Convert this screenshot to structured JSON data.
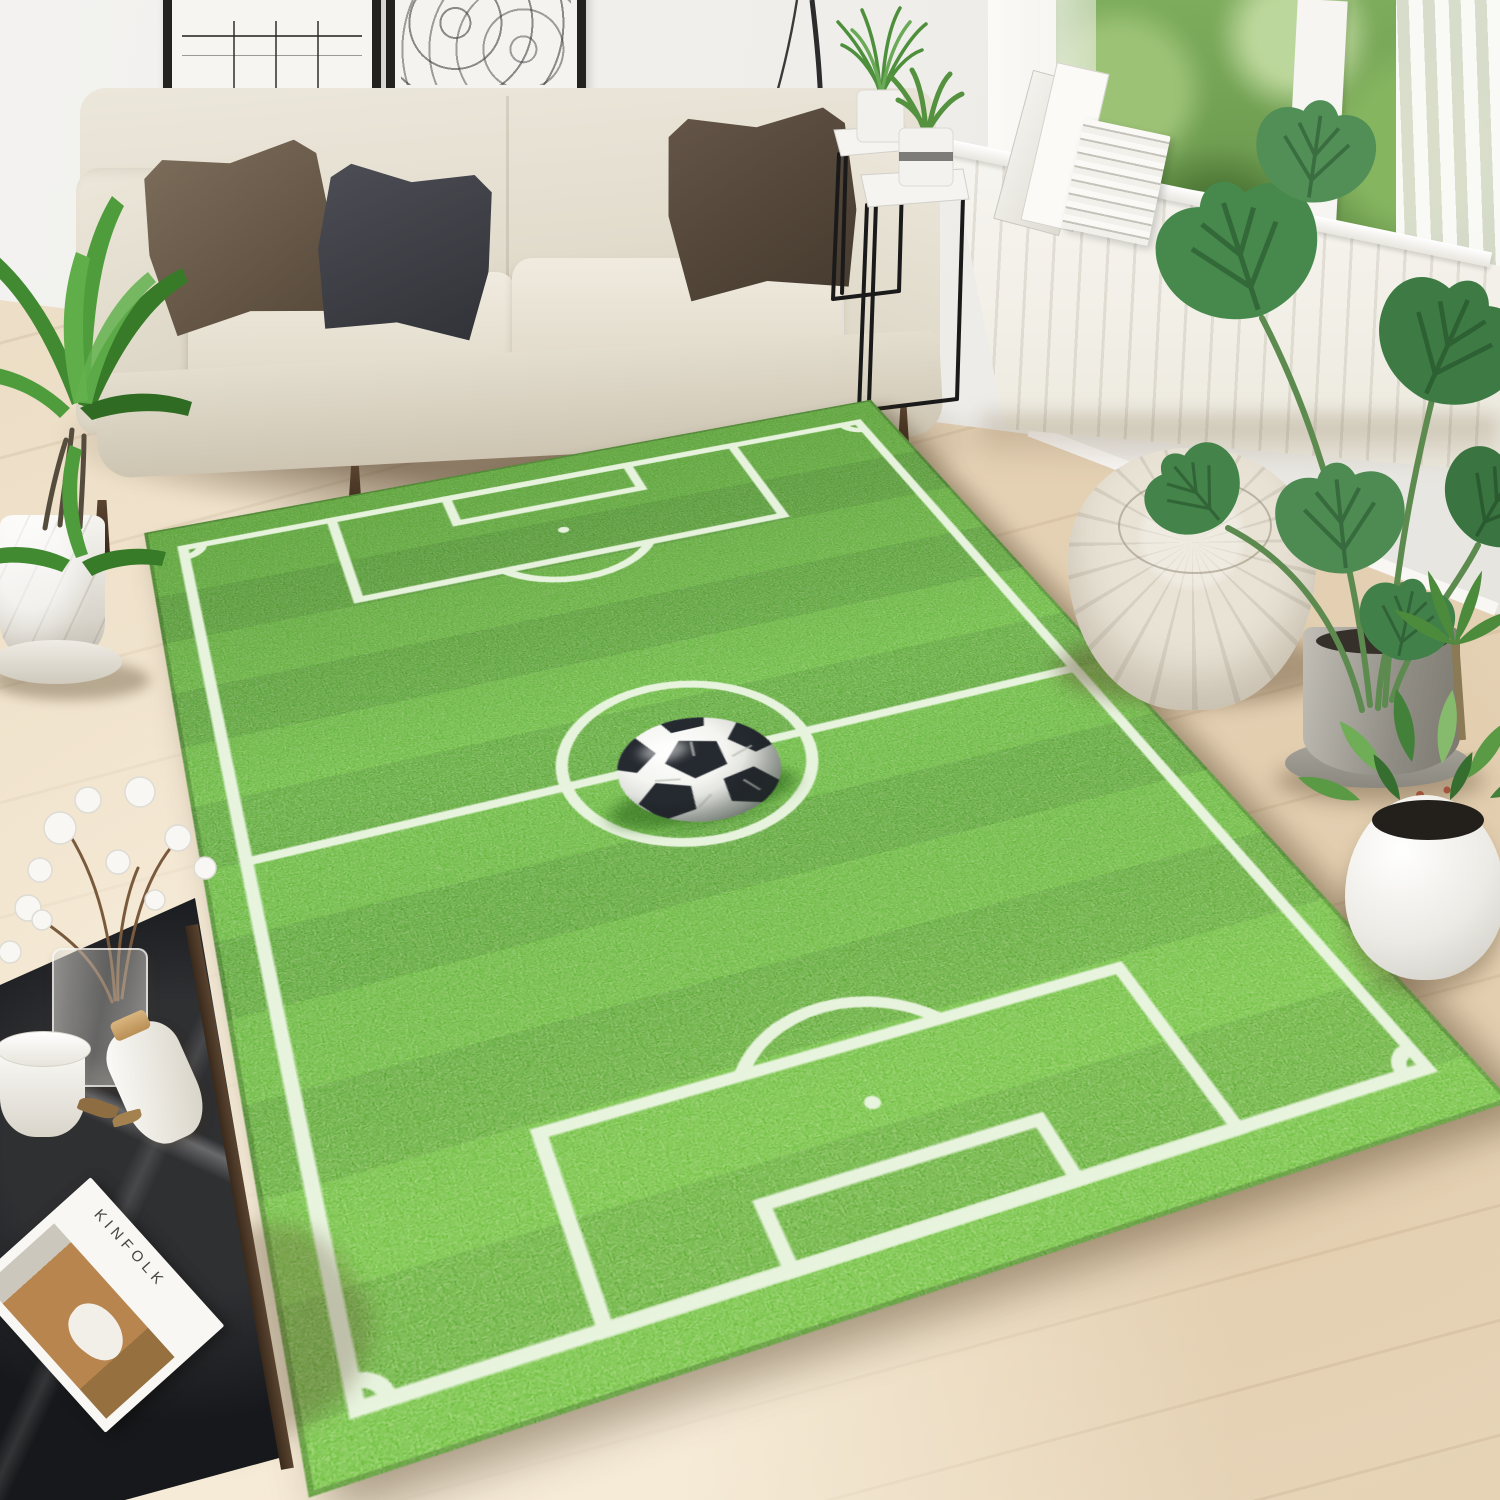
{
  "scene": {
    "description": "Bright living room with a soccer-field print area rug on a light wood floor",
    "room": {
      "wall_color": "#f1efec",
      "floor_color": "#ead9c0",
      "floor_light": "#f5ecd9",
      "baseboard_color": "#f8f7f4"
    },
    "wall_art": [
      {
        "name": "abstract plant line-art print",
        "frame_color": "#24221f",
        "mat_color": "#f6f5f2"
      },
      {
        "name": "net pattern print",
        "frame_color": "#24221f",
        "mat_color": "#f4f3f0"
      }
    ],
    "window": {
      "foliage_color": "#6f9e4c",
      "frame_color": "#f6f5f2",
      "curtain_color": "#fbfaf7"
    },
    "radiator_color": "#f5f3ee",
    "sofa": {
      "fabric_color": "#e7e2d5",
      "pillows": [
        {
          "color": "#6f5f4e"
        },
        {
          "color": "#44454b"
        },
        {
          "color": "#5a4c3f"
        }
      ],
      "leg_color": "#4a3729"
    },
    "pouf_color": "#e7e1d4",
    "plants": {
      "palm_green": "#4b9338",
      "monstera_green": "#47894d",
      "shrub_green": "#5a9a45",
      "table_plant_green": "#4e8f3b",
      "palm_pot_color": "#f0ede6",
      "monstera_pot_color": "#9b988f",
      "shrub_pot_color": "#f2f0ea"
    },
    "side_tables": {
      "top_color": "#f5f4f1",
      "leg_color": "#1a1a1a"
    },
    "coffee_table": {
      "top_color": "#17181b",
      "wood_edge_color": "#4a3526",
      "items": {
        "magazine_title": "KINFOLK",
        "magazine_cover_colors": [
          "#f8f7f4",
          "#b9854e"
        ],
        "bottle_cork_color": "#c89f66",
        "cotton_color": "#f8f7f3",
        "glass_vase": "translucent"
      }
    }
  },
  "rug": {
    "theme": "soccer field with center ball",
    "grass_base": "#4cae1e",
    "grass_dark_stripe": "#3e9a13",
    "line_color": "#ecf6e3",
    "markings": [
      "boundary",
      "halfway line",
      "center circle",
      "penalty areas",
      "goal areas",
      "penalty spots",
      "penalty arcs",
      "corner arcs"
    ],
    "ball": {
      "white": "#f5f5f3",
      "black": "#252a30"
    }
  }
}
